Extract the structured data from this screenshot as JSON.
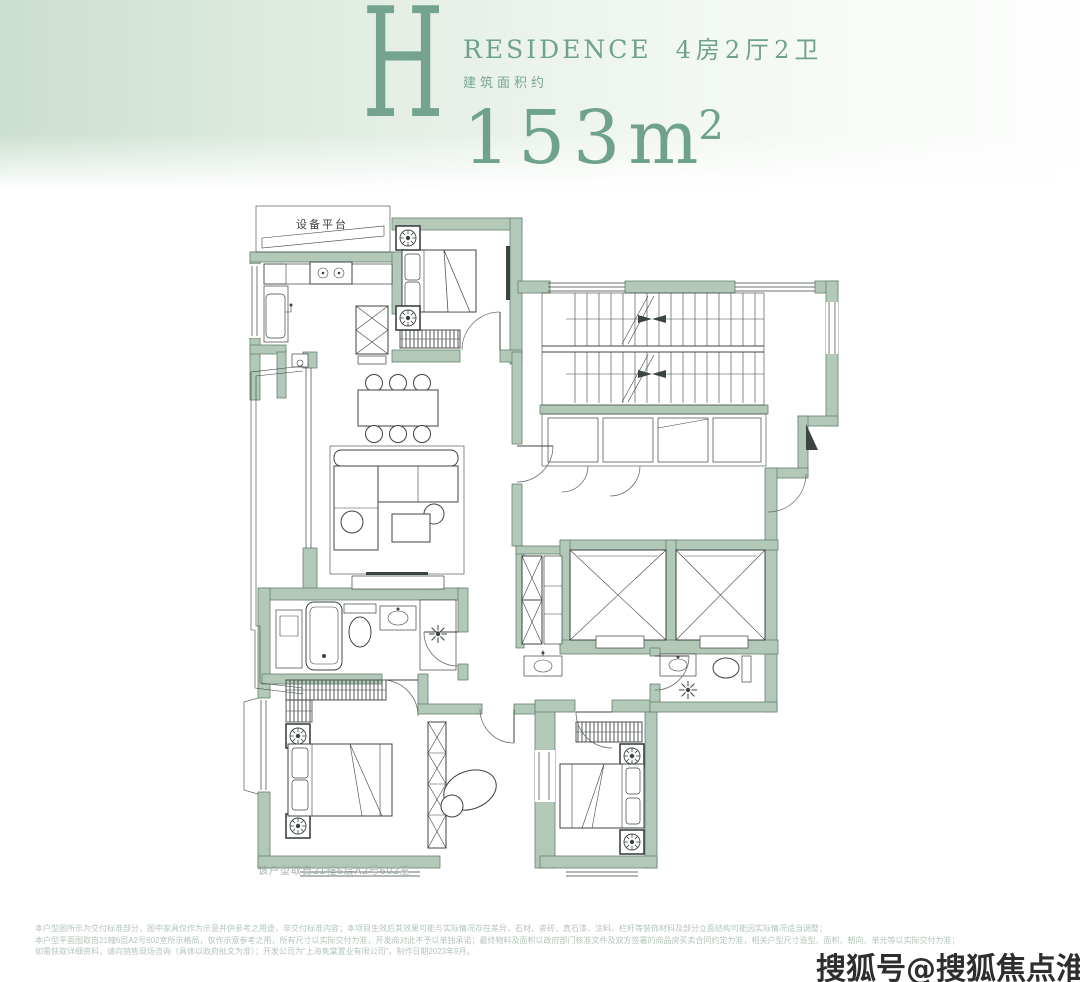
{
  "header": {
    "unit_letter": "H",
    "residence_label": "RESIDENCE",
    "layout_label": "4房2厅2卫",
    "area_prefix": "建筑面积约",
    "area_value": "153",
    "area_unit": "m",
    "area_sup": "2",
    "accent_color": "#6fa28d",
    "band_color_left": "#cbdfd0",
    "band_color_right": "#fdfefd"
  },
  "floorplan": {
    "equipment_platform_label": "设备平台",
    "unit_note": "该户型取自21幢6层A2号602室",
    "wall_color": "#b2c9b9",
    "line_color": "#3c4440"
  },
  "footer": {
    "disclaimer_lines": [
      "本户型图所示为交付标准部分，图中家具仅作为示意并供参考之用途，非交付标准内容；本项目生效后其效果可能与实际情况存在差异，石材、瓷砖、真石漆、涂料、栏杆等装饰材料及部分立面结构可能因实际情况适当调整；",
      "本户型平面图取自21幢6层A2号602室所示格局，仅作示意参考之用，所有尺寸以实际交付为准，开发商对此不予以单独承诺；最终物料及面积以政府部门核准文件及双方签署的商品房买卖合同约定为准，相关户型尺寸造型、面积、朝向、单元等以实际交付为准；",
      "如需获取详细资料，请向销售现场咨询（具体以政府批文为准）；开发公司为“上海隽棠置业有限公司”，制作日期2023年9月。"
    ]
  },
  "watermark": {
    "text": "搜狐号@搜狐焦点淮南站"
  }
}
